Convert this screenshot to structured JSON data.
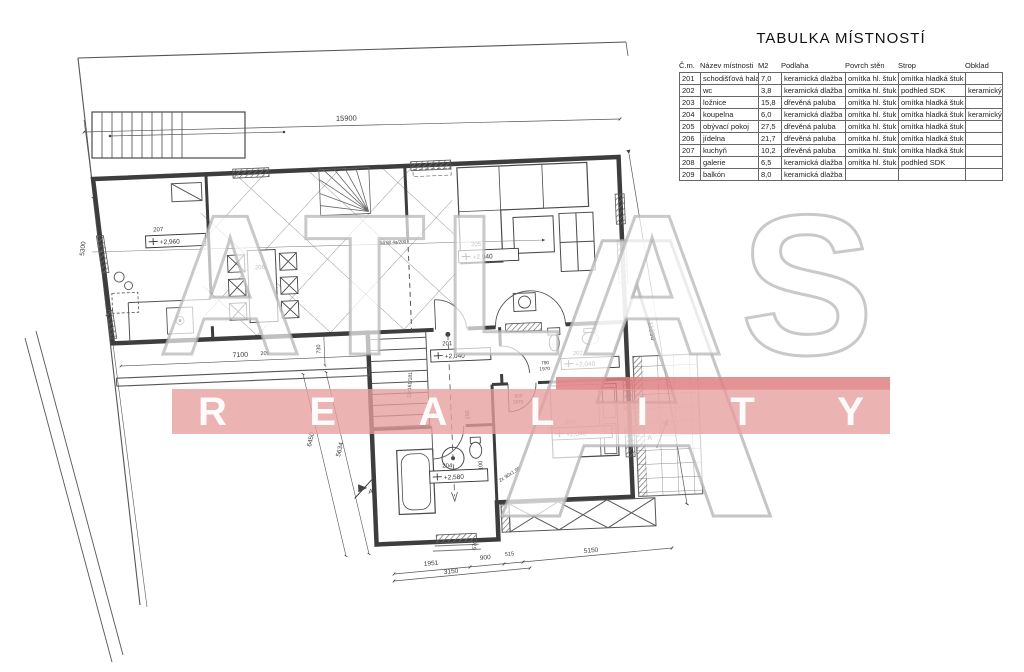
{
  "table": {
    "title": "TABULKA MÍSTNOSTÍ",
    "headers": [
      "Č.m.",
      "Název místnosti",
      "M2",
      "Podlaha",
      "Povrch stěn",
      "Strop",
      "Obklad"
    ],
    "col_widths": [
      21,
      58,
      23,
      64,
      53,
      67,
      37
    ],
    "rows": [
      [
        "201",
        "schodišťová hala",
        "7,0",
        "keramická dlažba",
        "omítka hl. štuk",
        "omítka hladká štuk",
        ""
      ],
      [
        "202",
        "wc",
        "3,8",
        "keramická dlažba",
        "omítka hl. štuk",
        "podhled SDK",
        "keramický"
      ],
      [
        "203",
        "ložnice",
        "15,8",
        "dřevěná paluba",
        "omítka hl. štuk",
        "omítka hladká štuk",
        ""
      ],
      [
        "204",
        "koupelna",
        "6,0",
        "keramická dlažba",
        "omítka hl. štuk",
        "omítka hladká štuk",
        "keramický"
      ],
      [
        "205",
        "obývací pokoj",
        "27,5",
        "dřevěná paluba",
        "omítka hl. štuk",
        "omítka hladká štuk",
        ""
      ],
      [
        "206",
        "jídelna",
        "21,7",
        "dřevěná paluba",
        "omítka hl. štuk",
        "omítka hladká štuk",
        ""
      ],
      [
        "207",
        "kuchyň",
        "10,2",
        "dřevěná paluba",
        "omítka hl. štuk",
        "omítka hladká štuk",
        ""
      ],
      [
        "208",
        "galerie",
        "6,5",
        "keramická dlažba",
        "omítka hl. štuk",
        "podhled SDK",
        ""
      ],
      [
        "209",
        "balkón",
        "8,0",
        "keramická dlažba",
        "",
        "",
        ""
      ]
    ]
  },
  "watermark": {
    "line1": "ATLAS",
    "line2": "REALITY",
    "big": "A",
    "band_color": "#e79e9e",
    "letter_color": "#ffffff",
    "gray_color": "#b4b4b4"
  },
  "plan": {
    "rooms": {
      "201": {
        "num": "201",
        "elev": "+2,040"
      },
      "202": {
        "num": "202",
        "elev": "+2,040"
      },
      "203": {
        "num": "203",
        "elev": "+2,040"
      },
      "204": {
        "num": "204",
        "elev": "+2,580"
      },
      "205": {
        "num": "205",
        "elev": "+2,940"
      },
      "206": {
        "num": "206"
      },
      "207": {
        "num": "207",
        "elev": "+2,960"
      }
    },
    "dims": {
      "top": "15900",
      "left": "5300",
      "terrace": "7100",
      "terrace_room": "209",
      "d730": "730",
      "d6450": "6450",
      "d5634": "5634",
      "right": "11250",
      "b1951": "1951",
      "b900": "900",
      "b515": "515",
      "b3150": "3150",
      "b5150": "5150",
      "v670": "670",
      "v150": "150",
      "v2100": "2100"
    },
    "specs": {
      "stair": "11x161/181",
      "door_wc_w": "790",
      "door_wc_h": "1970",
      "door_bed_w": "800",
      "door_bed_h": "1970",
      "window_bath": "2x 90x1,90",
      "lintel": "5a 80 4a/200"
    },
    "section_marker": "A"
  }
}
